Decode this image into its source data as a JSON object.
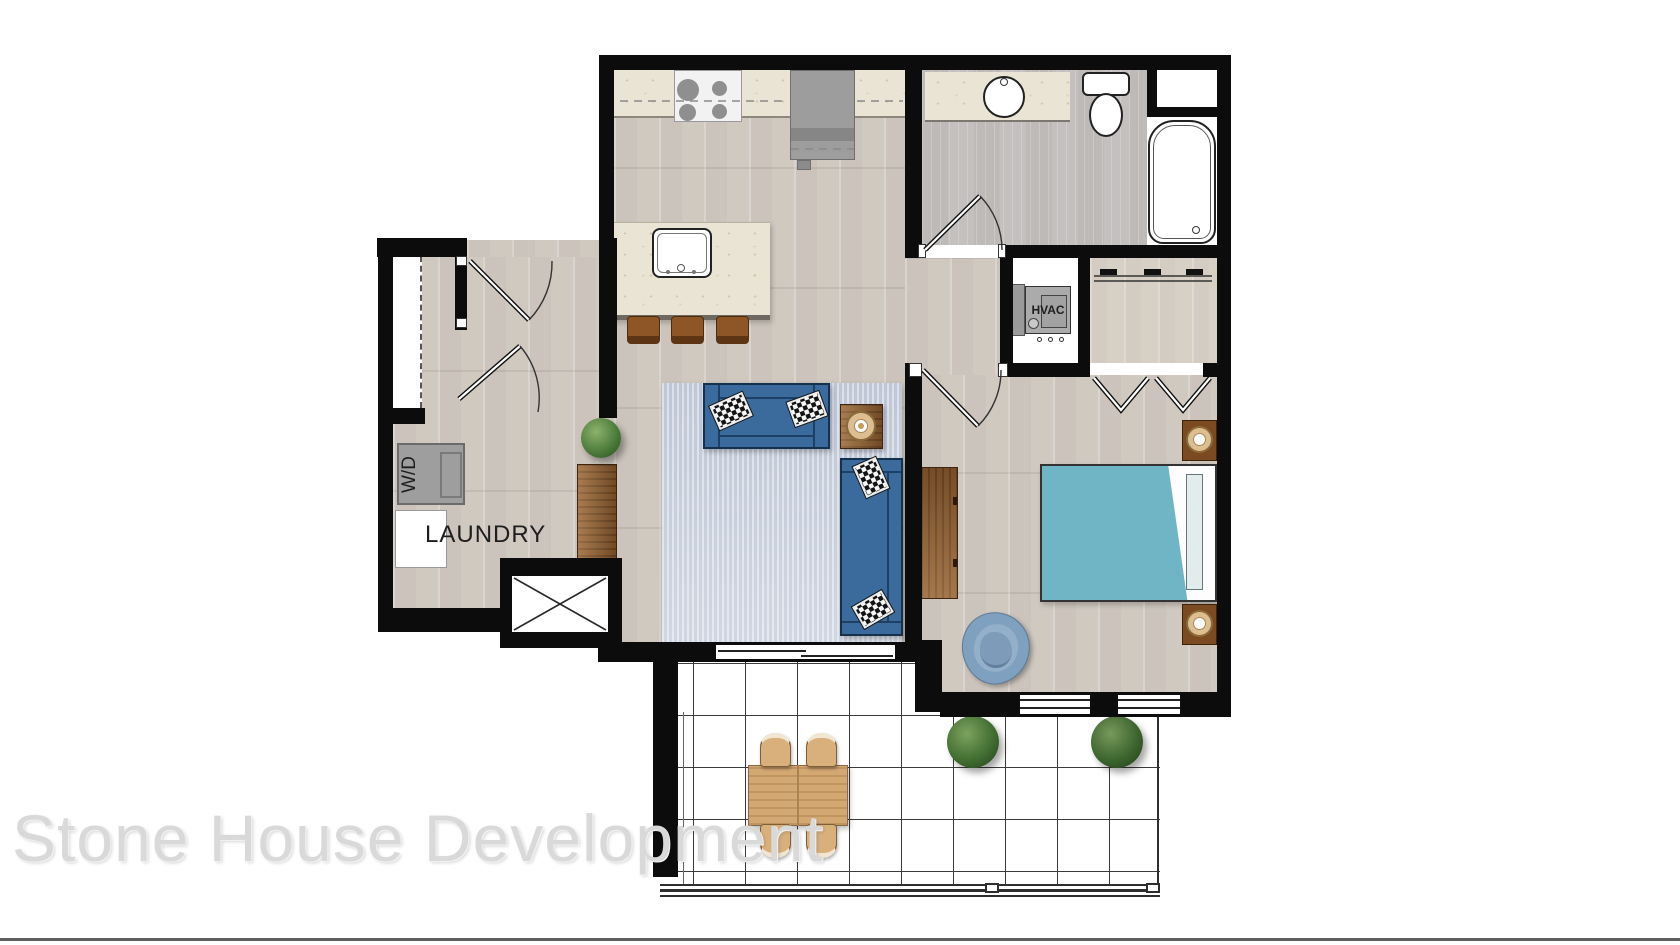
{
  "canvas": {
    "width": 1680,
    "height": 945
  },
  "watermark": {
    "text": "Stone House Development",
    "color": "#d9d9d9"
  },
  "labels": {
    "laundry": "LAUNDRY",
    "washer_dryer": "W/D",
    "hvac": "HVAC"
  },
  "plan": {
    "type": "apartment-floor-plan",
    "areas_depicted": [
      "kitchen",
      "bathroom",
      "laundry",
      "entry",
      "living-room",
      "bedroom",
      "bedroom-closet",
      "hvac-closet",
      "patio"
    ],
    "fixtures_depicted": [
      "range-stove",
      "refrigerator",
      "kitchen-island-with-sink",
      "bar-stools",
      "vanity-sink",
      "toilet",
      "bathtub",
      "linen-niche",
      "washer-dryer",
      "laundry-counter",
      "shaft-x-box",
      "hvac-unit",
      "sofa",
      "loveseat",
      "area-rug",
      "checker-pillows",
      "side-table-with-lamp",
      "console-table",
      "potted-plant",
      "bed-with-teal-blanket",
      "nightstands-with-lamps",
      "dresser",
      "swivel-armchair",
      "bifold-closet-doors",
      "outdoor-dining-table",
      "outdoor-chairs",
      "patio-shrubs",
      "balcony-railing",
      "tile-grid-patio",
      "door-swings",
      "sliding-patio-door",
      "windows"
    ]
  },
  "colors": {
    "wall": "#0c0c0c",
    "wood_floor": "#d5cec6",
    "bath_floor": "#c8c4c3",
    "marble_counter": "#eae4d4",
    "sofa_blue": "#3a6b9c",
    "rug_blue_gray": "#c9d0dd",
    "bed_teal": "#70b5c5",
    "furniture_wood": "#8a5a2e",
    "patio_table_wood": "#d4a873",
    "plant_green": "#4e7d3c",
    "appliance_gray": "#9e9e9e",
    "chair_blue": "#7fa0bf"
  }
}
